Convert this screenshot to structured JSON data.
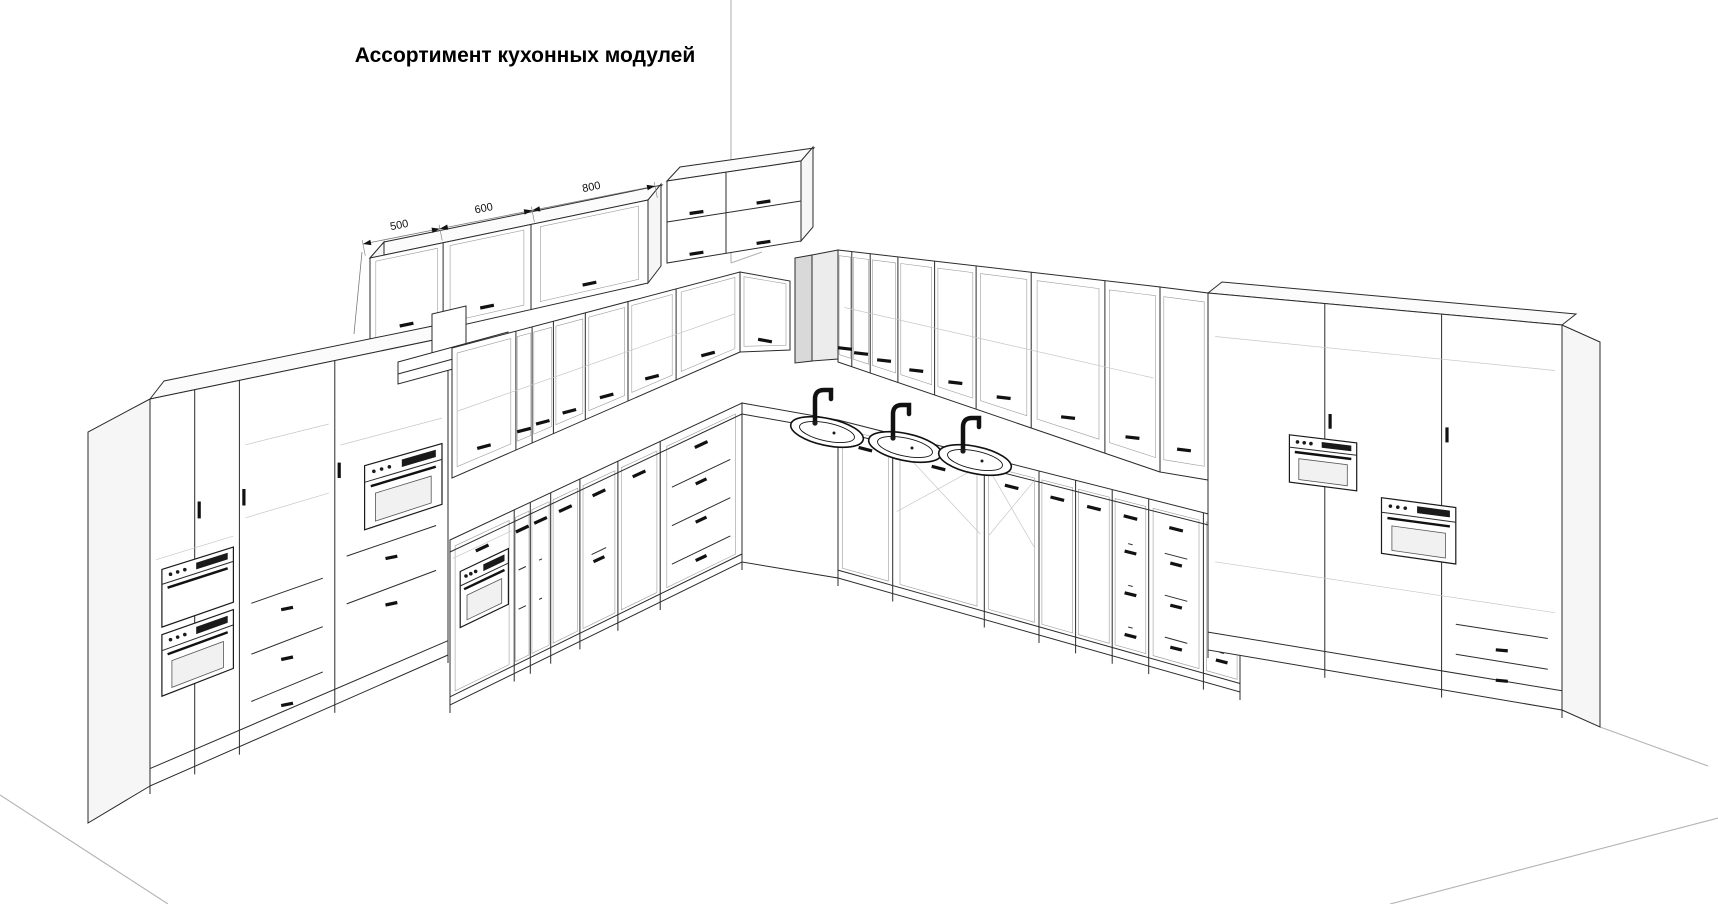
{
  "title": "Ассортимент кухонных модулей",
  "dims": {
    "wall_row1": [
      "500",
      "600",
      "800"
    ],
    "wall_row1_h": "360",
    "wall_block": [
      "600",
      "800"
    ],
    "wall_block_h": "710",
    "tall_left": [
      "600",
      "600",
      "600"
    ],
    "tall_left_h": "2160",
    "wall_mid": [
      "600",
      "150",
      "200",
      "300",
      "400",
      "450",
      "600",
      "800"
    ],
    "base_mid": [
      "150",
      "200",
      "300",
      "400",
      "450",
      "600"
    ],
    "corner_base": "800",
    "corner_wall_right": "600",
    "wall_right": [
      "150",
      "200",
      "300",
      "400",
      "450",
      "600",
      "800",
      "600",
      "600",
      "600",
      "600"
    ],
    "base_right": [
      "600",
      "1000",
      "600",
      "800",
      "400",
      "600",
      "400"
    ],
    "right_h": "2400"
  }
}
